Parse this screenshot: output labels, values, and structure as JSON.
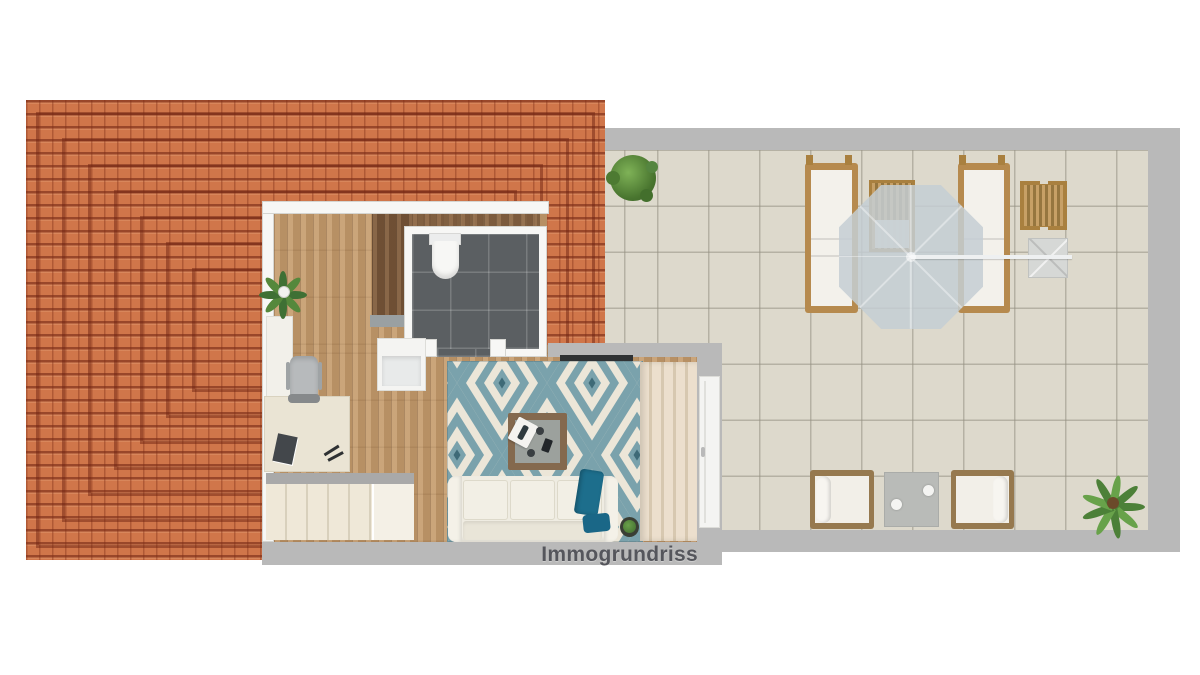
{
  "watermark": {
    "text": "Immogrundriss",
    "color": "#55565c"
  },
  "palette": {
    "roof_tile": "#d0764a",
    "roof_ridge": "#7a2d18",
    "terrace_tile": "#ddd9cc",
    "wall_gray": "#b9b9b9",
    "wall_white": "#f7f7f5",
    "wood_floor": "#c29a6d",
    "wood_dark": "#7c5a3c",
    "bathroom_tile": "#5b5f62",
    "rug_teal": "#7aa2ac",
    "rug_cream": "#ece6d8",
    "sofa_white": "#efece2",
    "blinds_cream": "#e7dcc9",
    "outdoor_wood": "#b68a4e",
    "cushion_white": "#f2efe8",
    "umbrella_gray": "#c4ced4",
    "accent_teal": "#1d6e8c",
    "plant_green": "#4e7d3a"
  },
  "scene": {
    "type": "floor-plan-top-view",
    "areas": [
      "tiled-roof",
      "attic-apartment",
      "bathroom",
      "home-office",
      "staircase",
      "living-area",
      "roof-terrace"
    ],
    "terrace_furniture": [
      "sun-lounger-left",
      "sun-lounger-right",
      "outdoor-dining-table",
      "cantilever-parasol",
      "parasol-base-cube",
      "slatted-side-table",
      "lounge-armchair-left",
      "lounge-armchair-right",
      "outdoor-coffee-table",
      "bush-plant",
      "palm-plant"
    ],
    "interior_furniture": [
      "toilet",
      "washbasin-cabinet",
      "houseplant",
      "sideboard",
      "office-chair",
      "desk",
      "staircase",
      "tv-panel",
      "area-rug",
      "coffee-table",
      "sofa",
      "throw-blanket",
      "pillow",
      "potted-plant",
      "vertical-blinds",
      "sliding-door"
    ]
  }
}
